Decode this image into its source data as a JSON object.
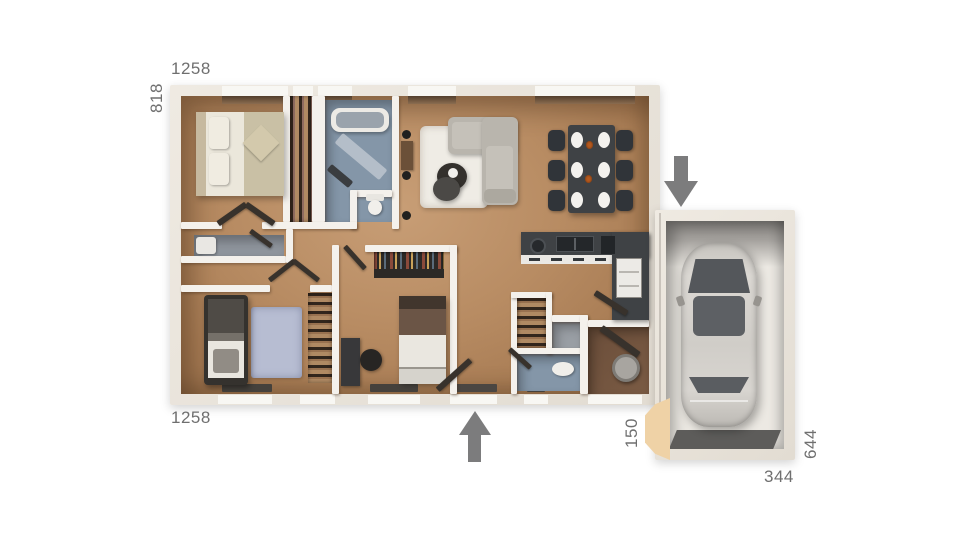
{
  "labels": {
    "house_width_top": "1258",
    "house_height_left": "818",
    "house_width_bottom": "1258",
    "garage_offset": "150",
    "garage_height": "644",
    "garage_width": "344"
  },
  "icons": {
    "garage_entry": "arrow-down-icon",
    "main_entry": "arrow-up-icon"
  },
  "colors": {
    "wall_fill": "#e9e3da",
    "wall_inner": "#f4f1ec",
    "wood_floor_light": "#c89e76",
    "wood_floor_dark": "#9a714c",
    "bath_floor": "#8496a8",
    "gray_floor": "#8f959d",
    "counter_dark": "#3f4245",
    "furniture_dark": "#303439",
    "rug_white": "#efece5",
    "rug_blue": "#b7bdd2",
    "sofa_gray": "#b9b5ad",
    "bed_beige": "#c9c0a5",
    "closet_wood": "#b08a63",
    "laundry_floor": "#7a5b44",
    "garage_floor": "#ece9e3",
    "garage_apron": "#5d5c5a",
    "car_body": "#d9d6d1",
    "car_glass": "#54575b",
    "tan_block": "#efd2a6",
    "arrow_gray": "#7c7c7d",
    "label_text": "#6f6f6f"
  }
}
